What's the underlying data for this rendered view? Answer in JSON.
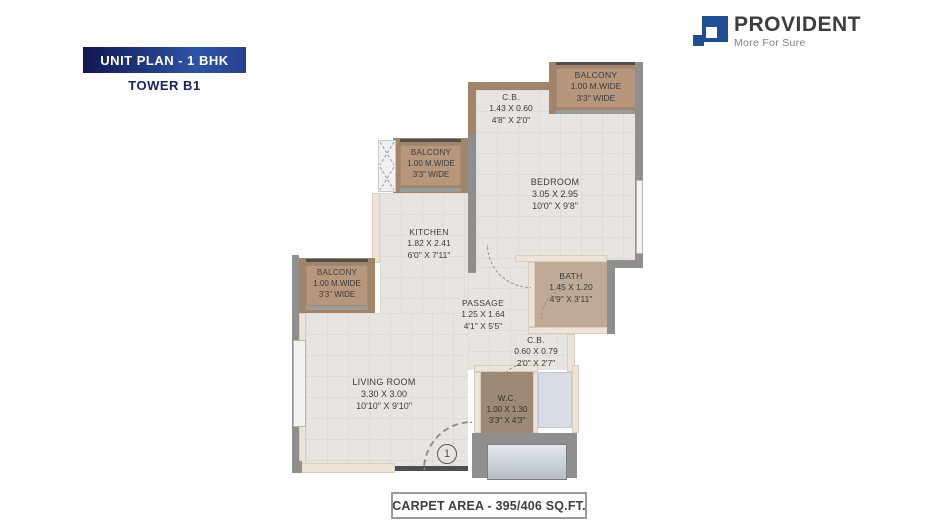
{
  "header": {
    "badge_label": "UNIT PLAN - 1 BHK",
    "tower_label": "TOWER B1"
  },
  "brand": {
    "name": "PROVIDENT",
    "tagline": "More For Sure",
    "color": "#1d4f91"
  },
  "rooms": [
    {
      "id": "balcony-top",
      "name": "BALCONY",
      "dims_m": "1.00 M.WIDE",
      "dims_ft": "3'3\" WIDE"
    },
    {
      "id": "cb-top",
      "name": "C.B.",
      "dims_m": "1.43 X 0.60",
      "dims_ft": "4'8\" X 2'0\""
    },
    {
      "id": "bedroom",
      "name": "BEDROOM",
      "dims_m": "3.05 X 2.95",
      "dims_ft": "10'0\" X 9'8\""
    },
    {
      "id": "balcony-kitchen",
      "name": "BALCONY",
      "dims_m": "1.00 M.WIDE",
      "dims_ft": "3'3\" WIDE"
    },
    {
      "id": "kitchen",
      "name": "KITCHEN",
      "dims_m": "1.82 X 2.41",
      "dims_ft": "6'0\" X 7'11\""
    },
    {
      "id": "balcony-living",
      "name": "BALCONY",
      "dims_m": "1.00 M.WIDE",
      "dims_ft": "3'3\" WIDE"
    },
    {
      "id": "passage",
      "name": "PASSAGE",
      "dims_m": "1.25 X 1.64",
      "dims_ft": "4'1\" X 5'5\""
    },
    {
      "id": "bath",
      "name": "BATH",
      "dims_m": "1.45 X 1.20",
      "dims_ft": "4'9\" X 3'11\""
    },
    {
      "id": "cb-mid",
      "name": "C.B.",
      "dims_m": "0.60 X 0.79",
      "dims_ft": "2'0\" X 2'7\""
    },
    {
      "id": "living",
      "name": "LIVING ROOM",
      "dims_m": "3.30 X 3.00",
      "dims_ft": "10'10\" X 9'10\""
    },
    {
      "id": "wc",
      "name": "W.C.",
      "dims_m": "1.00 X 1.30",
      "dims_ft": "3'3\" X 4'3\""
    }
  ],
  "entry": {
    "marker": "1"
  },
  "footer": {
    "carpet_area_label": "CARPET AREA - 395/406 SQ.FT."
  },
  "colors": {
    "badge_dark": "#10174e",
    "badge_blue": "#2e54a6",
    "brand_blue": "#1d4f91",
    "wall_brown": "#a2846a",
    "balcony_fill": "#b6977c",
    "floor": "#e6e5e1",
    "wall_gray": "#8f8f90",
    "bath_floor": "#bfab95",
    "wc_floor": "#9d8a76",
    "shaft_fill": "#d8dde5",
    "label_text": "#3c3c3c"
  }
}
